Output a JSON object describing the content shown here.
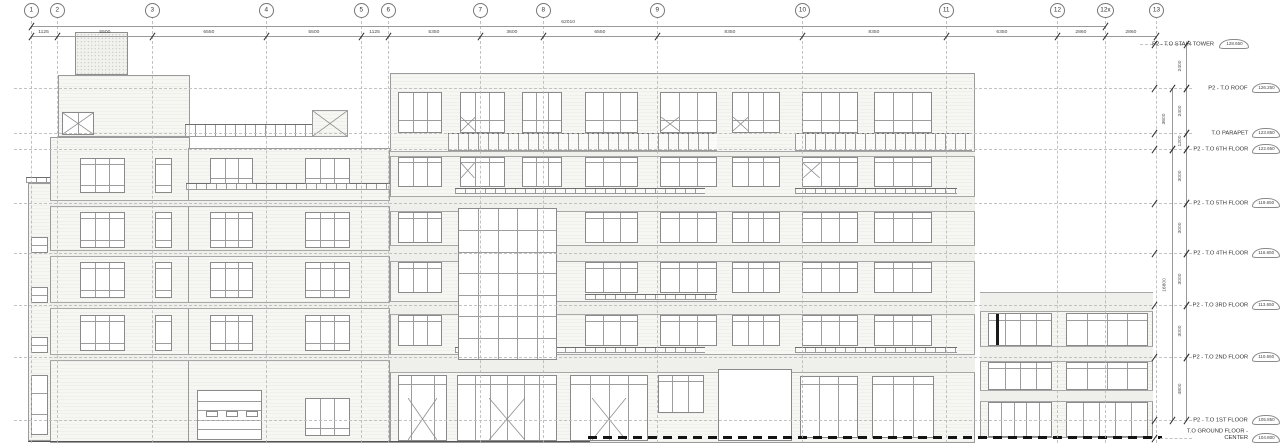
{
  "drawing": {
    "name": "P2 building elevation",
    "grid_labels": [
      "1",
      "2",
      "3",
      "4",
      "5",
      "6",
      "7",
      "8",
      "9",
      "10",
      "11",
      "12",
      "12x",
      "13"
    ],
    "top_dimensions": {
      "overall": "62010",
      "segments": [
        "1125",
        "5500",
        "6550",
        "5500",
        "1125",
        "5350",
        "3600",
        "6550",
        "8350",
        "8350",
        "6350",
        "2860",
        "2860"
      ]
    },
    "levels": [
      {
        "name": "P2 - T.O STAIR TOWER",
        "elevation": "128.650"
      },
      {
        "name": "P2 - T.O ROOF",
        "elevation": "126.250"
      },
      {
        "name": "T.O PARAPET",
        "elevation": "123.850"
      },
      {
        "name": "P2 - T.O 6TH FLOOR",
        "elevation": "122.650"
      },
      {
        "name": "P2 - T.O 5TH FLOOR",
        "elevation": "119.650"
      },
      {
        "name": "P2 - T.O 4TH FLOOR",
        "elevation": "116.650"
      },
      {
        "name": "P2 - T.O 3RD FLOOR",
        "elevation": "113.650"
      },
      {
        "name": "P2 - T.O 2ND FLOOR",
        "elevation": "110.650"
      },
      {
        "name": "P2 - T.O 1ST FLOOR",
        "elevation": "105.850"
      },
      {
        "name": "T.O GROUND FLOOR - CENTER",
        "elevation": "104.800"
      }
    ],
    "vertical_dimensions": {
      "outer": [
        "2400",
        "2400",
        "1200",
        "3000",
        "3000",
        "3000",
        "3000",
        "4800"
      ],
      "inner": [
        "3600",
        "16800"
      ]
    }
  }
}
